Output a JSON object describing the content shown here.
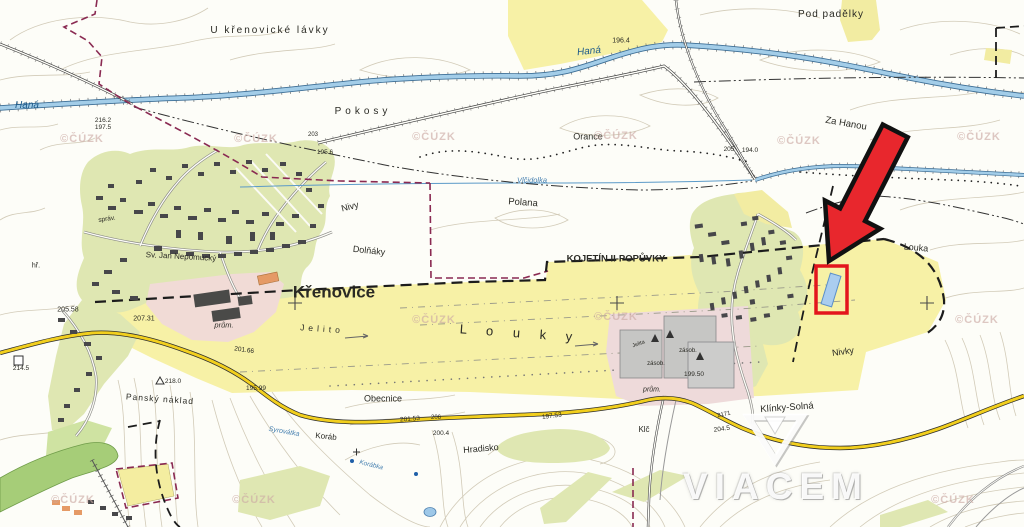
{
  "map": {
    "description": "Czech cadastral / topographic map excerpt with highlighted parcel",
    "source_watermark": "©ČÚZK",
    "colors": {
      "field_yellow": "#f7f1a6",
      "village_green": "#dfe7b2",
      "water_blue": "#a3cde8",
      "road_yellow": "#f2cf1d",
      "boundary_maroon": "#8a2a52",
      "highlight_red": "#e8272d",
      "parcel_blue": "#aacdef"
    },
    "marker": {
      "type": "arrow-with-box",
      "color": "#e8272d"
    },
    "watermarks": [
      [
        82,
        139
      ],
      [
        256,
        139
      ],
      [
        434,
        137
      ],
      [
        616,
        136
      ],
      [
        799,
        141
      ],
      [
        979,
        137
      ],
      [
        434,
        320
      ],
      [
        616,
        317
      ],
      [
        977,
        320
      ],
      [
        73,
        500
      ],
      [
        254,
        500
      ],
      [
        953,
        500
      ]
    ],
    "labels": [
      {
        "text": "U křenovické lávky",
        "x": 270,
        "y": 31,
        "size": 10,
        "ls": 2
      },
      {
        "text": "Haná",
        "x": 27,
        "y": 106,
        "size": 10,
        "italic": true,
        "color": "#1c5a8a"
      },
      {
        "text": "Pokosy",
        "x": 363,
        "y": 112,
        "size": 10,
        "ls": 4
      },
      {
        "text": "Haná",
        "x": 589,
        "y": 52,
        "size": 10,
        "italic": true,
        "color": "#1c5a8a",
        "rot": -6
      },
      {
        "text": "196.4",
        "x": 621,
        "y": 41,
        "size": 7
      },
      {
        "text": "Pod padělky",
        "x": 831,
        "y": 15,
        "size": 10,
        "ls": 1
      },
      {
        "text": "Orance",
        "x": 588,
        "y": 137,
        "size": 9
      },
      {
        "text": "Za Hanou",
        "x": 846,
        "y": 124,
        "size": 9.5,
        "rot": 10
      },
      {
        "text": "205",
        "x": 729,
        "y": 150,
        "size": 6.5
      },
      {
        "text": "194.0",
        "x": 750,
        "y": 151,
        "size": 6.5
      },
      {
        "text": "Vlčidolka",
        "x": 532,
        "y": 180,
        "size": 7.5,
        "italic": true,
        "color": "#4780b0"
      },
      {
        "text": "Polana",
        "x": 523,
        "y": 203,
        "size": 9.5,
        "rot": 4
      },
      {
        "text": "Nivy",
        "x": 350,
        "y": 207,
        "size": 9,
        "rot": -14
      },
      {
        "text": "Dolňáky",
        "x": 369,
        "y": 251,
        "size": 9,
        "rot": 6
      },
      {
        "text": "KOJETÍN II-POPŮVKY",
        "x": 616,
        "y": 259,
        "size": 9.5,
        "bold": true
      },
      {
        "text": "Křenovice",
        "x": 334,
        "y": 292,
        "size": 17,
        "bold": true
      },
      {
        "text": "L o u k y",
        "x": 520,
        "y": 333,
        "size": 13,
        "ls": 8,
        "rot": 4
      },
      {
        "text": "Jelito",
        "x": 322,
        "y": 329,
        "size": 8.5,
        "ls": 4,
        "rot": 4
      },
      {
        "text": "Sv. Jan Nepomucký",
        "x": 181,
        "y": 257,
        "size": 8,
        "rot": 3
      },
      {
        "text": "správ.",
        "x": 107,
        "y": 220,
        "size": 6.5,
        "rot": -8
      },
      {
        "text": "hř.",
        "x": 36,
        "y": 266,
        "size": 7
      },
      {
        "text": "216.2",
        "x": 103,
        "y": 121,
        "size": 6.5
      },
      {
        "text": "197.5",
        "x": 103,
        "y": 128,
        "size": 6.5
      },
      {
        "text": "203",
        "x": 313,
        "y": 135,
        "size": 6
      },
      {
        "text": "195.6",
        "x": 325,
        "y": 153,
        "size": 6.5
      },
      {
        "text": "205.58",
        "x": 68,
        "y": 310,
        "size": 7
      },
      {
        "text": "207.31",
        "x": 144,
        "y": 319,
        "size": 7
      },
      {
        "text": "prům.",
        "x": 224,
        "y": 325,
        "size": 7.5,
        "italic": true
      },
      {
        "text": "Louka",
        "x": 916,
        "y": 248,
        "size": 9,
        "rot": 5
      },
      {
        "text": "Nivky",
        "x": 843,
        "y": 352,
        "size": 9,
        "rot": -8
      },
      {
        "text": "Klínky-Solná",
        "x": 787,
        "y": 408,
        "size": 9.5,
        "rot": -4
      },
      {
        "text": "199.50",
        "x": 694,
        "y": 375,
        "size": 6.5
      },
      {
        "text": "zásob.",
        "x": 688,
        "y": 351,
        "size": 6
      },
      {
        "text": "zásob.",
        "x": 656,
        "y": 364,
        "size": 6
      },
      {
        "text": "prům.",
        "x": 652,
        "y": 390,
        "size": 7,
        "italic": true
      },
      {
        "text": "Jelita",
        "x": 639,
        "y": 345,
        "size": 5.5,
        "rot": -20
      },
      {
        "text": "Obecnice",
        "x": 383,
        "y": 399,
        "size": 9
      },
      {
        "text": "Hradisko",
        "x": 481,
        "y": 449,
        "size": 9,
        "rot": -5
      },
      {
        "text": "Klč",
        "x": 644,
        "y": 430,
        "size": 8
      },
      {
        "text": "201.66",
        "x": 244,
        "y": 351,
        "size": 6.5,
        "rot": 8
      },
      {
        "text": "218.0",
        "x": 173,
        "y": 382,
        "size": 6.5
      },
      {
        "text": "Panský náklad",
        "x": 160,
        "y": 399,
        "size": 8.5,
        "rot": 4,
        "ls": 1
      },
      {
        "text": "195.99",
        "x": 256,
        "y": 389,
        "size": 6.5
      },
      {
        "text": "214.5",
        "x": 21,
        "y": 369,
        "size": 6.5
      },
      {
        "text": "Syrovátka",
        "x": 284,
        "y": 432,
        "size": 7,
        "italic": true,
        "color": "#4780b0",
        "rot": 10
      },
      {
        "text": "Koráb",
        "x": 326,
        "y": 437,
        "size": 8,
        "rot": 6
      },
      {
        "text": "Korábka",
        "x": 371,
        "y": 466,
        "size": 6.5,
        "italic": true,
        "color": "#4780b0",
        "rot": 14
      },
      {
        "text": "201.53",
        "x": 410,
        "y": 420,
        "size": 6.5,
        "rot": -4
      },
      {
        "text": "206",
        "x": 436,
        "y": 418,
        "size": 6
      },
      {
        "text": "200.4",
        "x": 441,
        "y": 434,
        "size": 6.5
      },
      {
        "text": "197.53",
        "x": 552,
        "y": 417,
        "size": 6.5,
        "rot": -8
      },
      {
        "text": "2171",
        "x": 724,
        "y": 415,
        "size": 6,
        "rot": -12
      },
      {
        "text": "204.5",
        "x": 722,
        "y": 430,
        "size": 6.5,
        "rot": -8
      }
    ]
  },
  "branding": {
    "logo_text": "VIACEM"
  }
}
